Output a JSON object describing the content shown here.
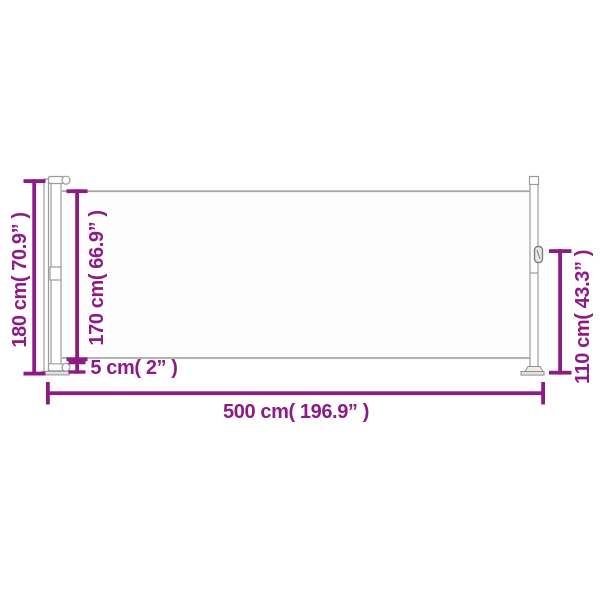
{
  "page": {
    "background": "#ffffff",
    "description": "Dimension diagram of an extended retractable side awning"
  },
  "diagram": {
    "labels": {
      "total_height": "180 cm( 70.9” )",
      "fabric_height": "170 cm( 66.9” )",
      "bottom_clearance": "5 cm( 2” )",
      "total_length": "500 cm( 196.9” )",
      "end_post_height": "110 cm( 43.3” )"
    },
    "colors": {
      "dimension_accent": "#8d1b86",
      "structure_outline": "#9b9b9b",
      "fabric_edge": "#a8a8a8",
      "base_fill": "#e3e3e3"
    },
    "icons": {
      "pull_handle": "handle-icon"
    }
  }
}
